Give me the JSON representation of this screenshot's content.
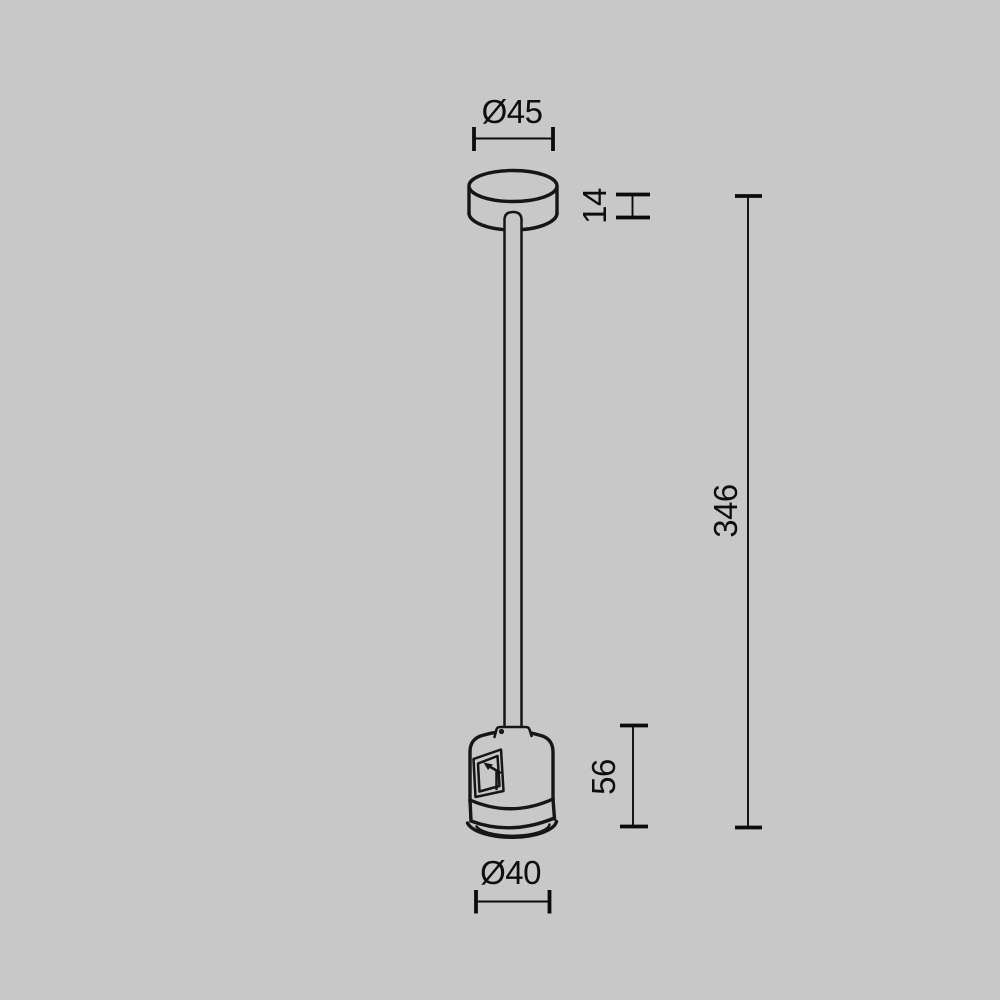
{
  "canvas": {
    "background_color": "#c8c8c8",
    "line_color": "#161616",
    "dimension_color": "#0c0c0c"
  },
  "figure": {
    "type": "technical-dimension-drawing",
    "labels": {
      "canopy_diameter": "Ø45",
      "canopy_height": "14",
      "overall_length": "346",
      "connector_height": "56",
      "connector_diameter": "Ø40"
    }
  }
}
